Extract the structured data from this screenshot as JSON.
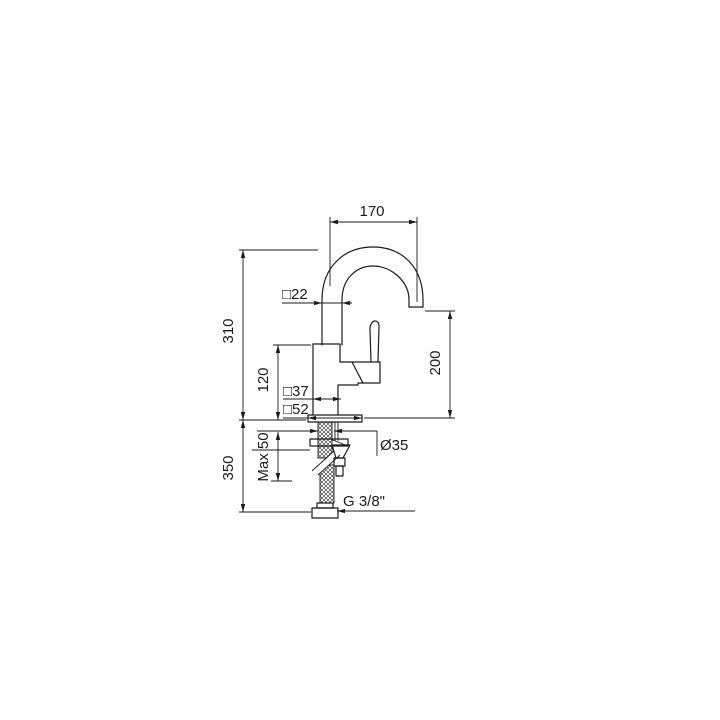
{
  "drawing": {
    "labels": {
      "spout_reach": "170",
      "spout_section": "□22",
      "spout_height": "310",
      "body_height": "120",
      "outlet_height": "200",
      "body_section": "□37",
      "base_section": "□52",
      "max_deck": "Max 50",
      "hose_drop": "350",
      "hole_diameter": "Ø35",
      "thread": "G 3/8\""
    },
    "line_color": "#1a1a1a",
    "background": "#ffffff"
  }
}
